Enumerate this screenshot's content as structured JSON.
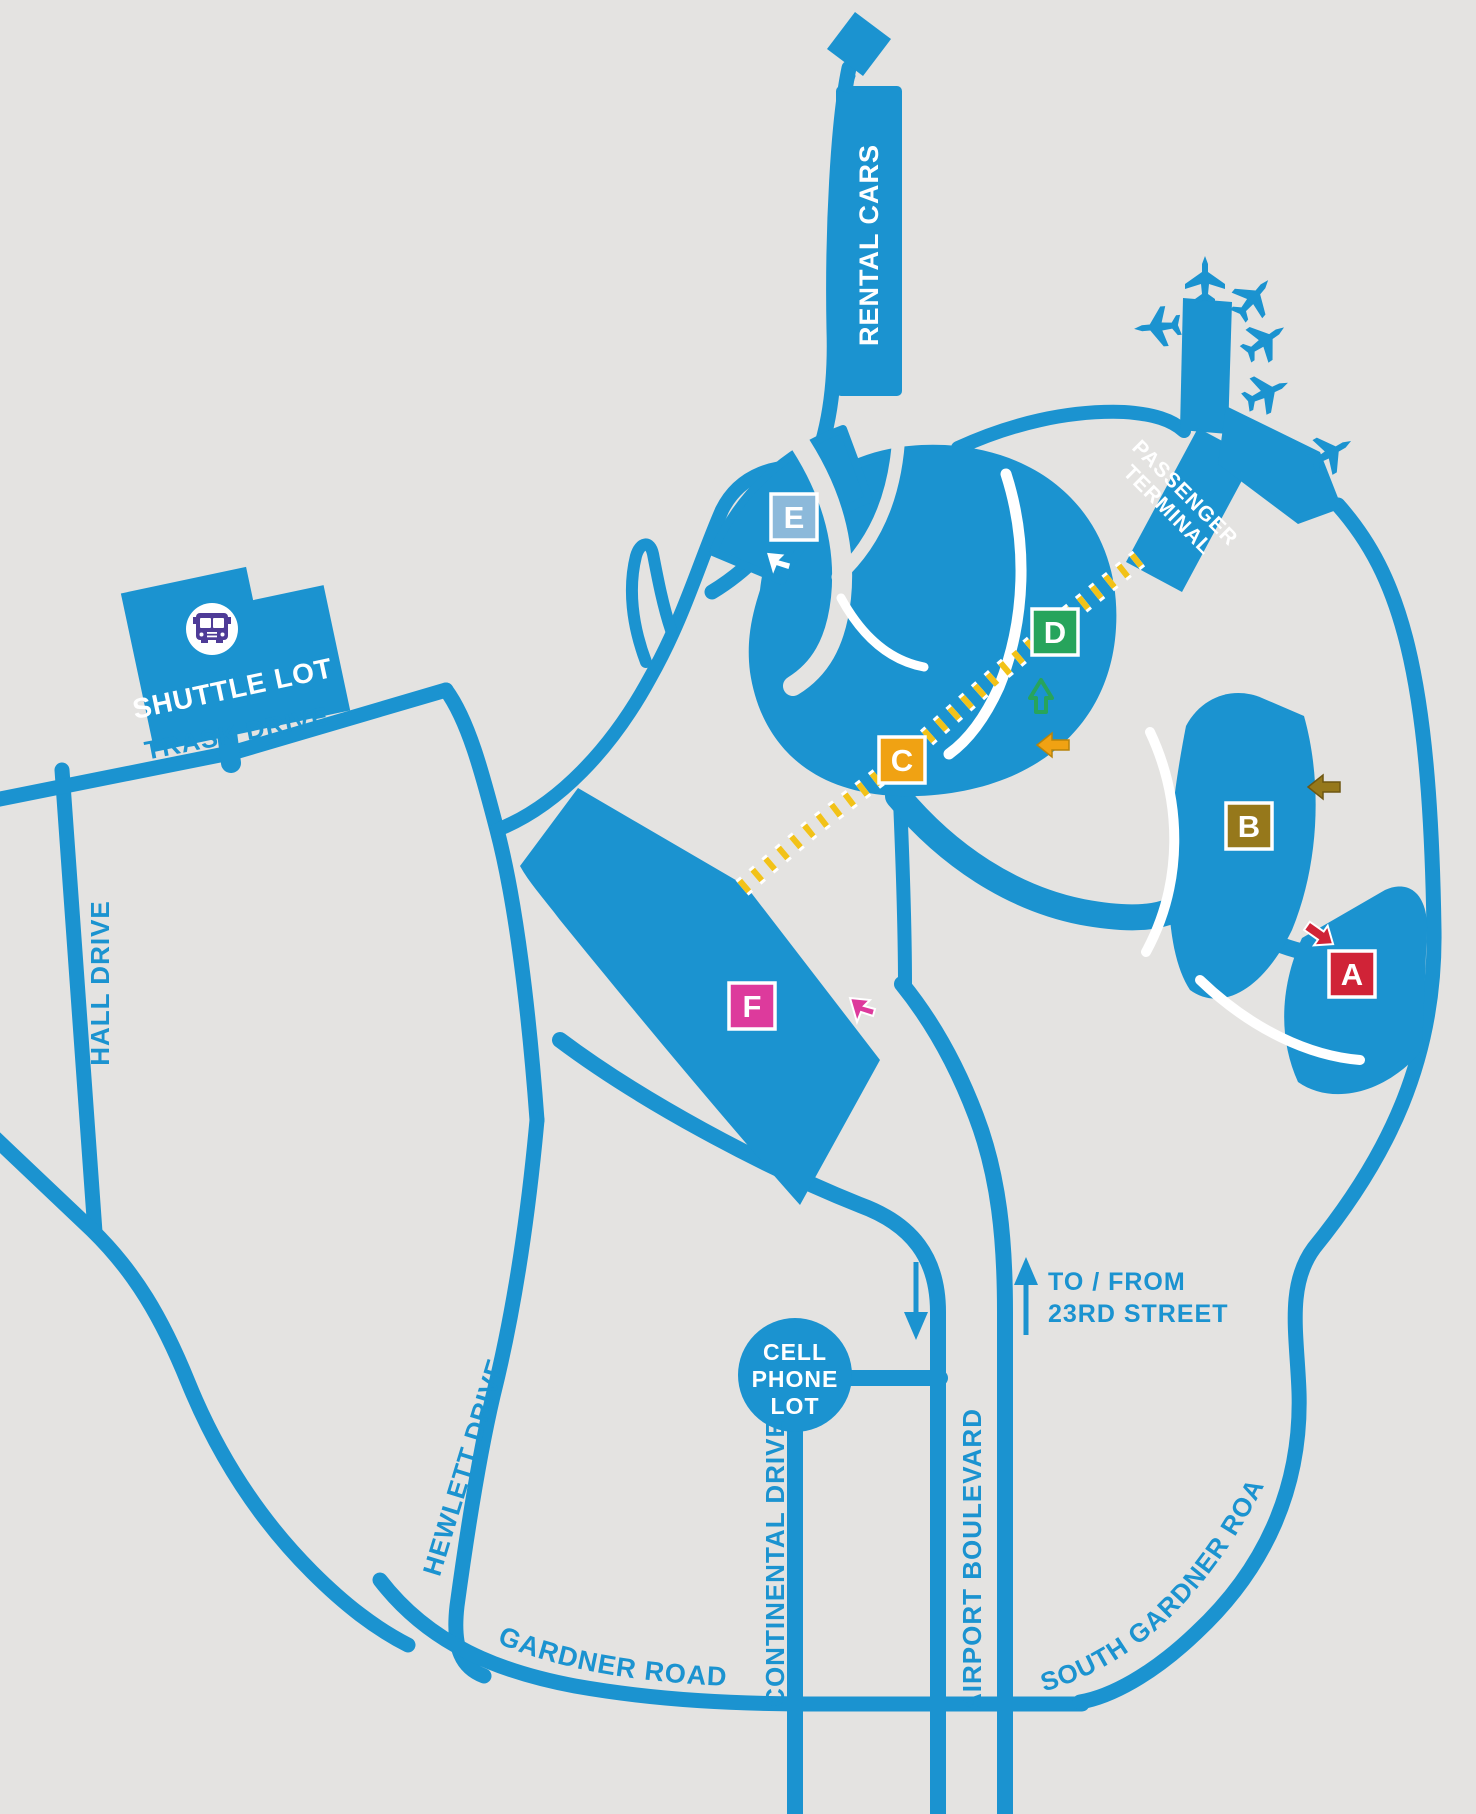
{
  "title": "Airport parking and roadway map",
  "colors": {
    "background": "#e4e3e1",
    "road_blue": "#1b93d0",
    "crosswalk_yellow": "#f2c218",
    "bus_purple": "#4e3b97",
    "white": "#ffffff"
  },
  "terminal": {
    "label_line1": "PASSENGER",
    "label_line2": "TERMINAL"
  },
  "rental": {
    "label": "RENTAL CARS"
  },
  "shuttle": {
    "label": "SHUTTLE LOT"
  },
  "cell_phone_lot": {
    "line1": "CELL",
    "line2": "PHONE",
    "line3": "LOT"
  },
  "street_note": {
    "line1": "TO / FROM",
    "line2": "23RD STREET"
  },
  "roads": {
    "trask": "TRASK DRIVE",
    "hall": "HALL DRIVE",
    "hewlett": "HEWLETT DRIVE",
    "gardner": "GARDNER ROAD",
    "continental": "CONTINENTAL DRIVE",
    "airport": "AIRPORT BOULEVARD",
    "south_gardner": "SOUTH GARDNER ROAD"
  },
  "lots": [
    {
      "letter": "A",
      "color": "#d02337"
    },
    {
      "letter": "B",
      "color": "#96781b"
    },
    {
      "letter": "C",
      "color": "#f0a213"
    },
    {
      "letter": "D",
      "color": "#27a45c"
    },
    {
      "letter": "E",
      "color": "#8cb9da"
    },
    {
      "letter": "F",
      "color": "#dd3a9c"
    }
  ],
  "arrows": {
    "white_cursor": "#ffffff",
    "pink_cursor": "#dd3a9c",
    "green_up": "#27a45c",
    "orange_left": "#f0a213",
    "gold_left": "#96781b",
    "red_diagonal": "#d02337",
    "boulevard_blue": "#1b93d0"
  },
  "icons": {
    "bus": "bus-icon",
    "airplane": "airplane-icon",
    "cursor": "cursor-arrow-icon"
  }
}
